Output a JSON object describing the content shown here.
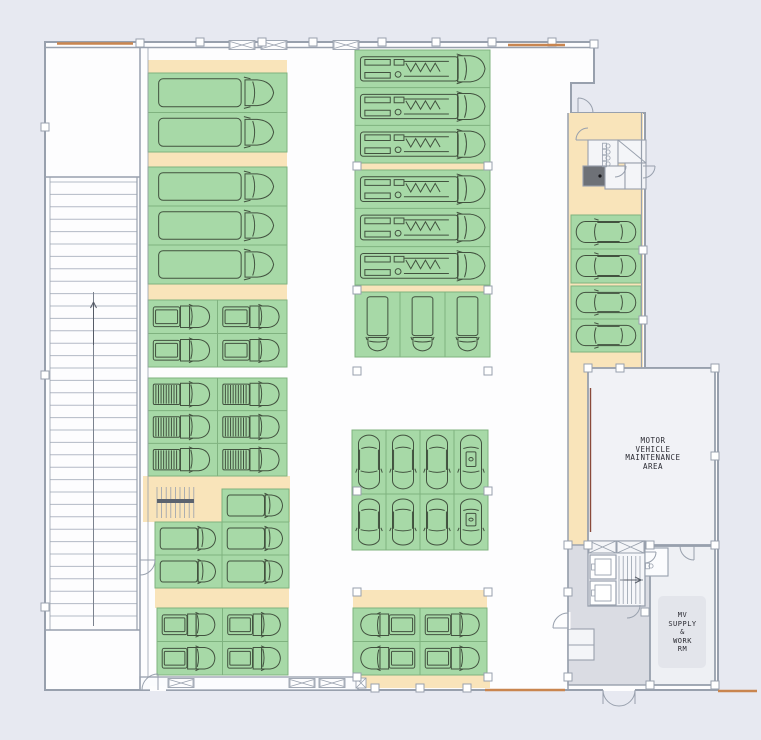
{
  "labels": {
    "maintenance": "MOTOR\nVEHICLE\nMAINTENANCE\nAREA",
    "supply": "MV\nSUPPLY\n&\nWORK\nRM"
  },
  "colors": {
    "page_bg": "#e7e9f1",
    "floor": "#fdfdfe",
    "wall": "#98a0ad",
    "wall_light": "#b3bac5",
    "tan": "#f9e4ba",
    "stall_green": "#a7d9a7",
    "stall_border": "#7fb27f",
    "vehicle": "#42523f",
    "lobby_gray": "#dadce3",
    "room_light": "#f2f3f7",
    "dark_unit": "#6e7177",
    "accent_orange": "#c9854f",
    "accent_brown": "#8a4a3a",
    "label_text": "#2b2b33"
  },
  "plan": {
    "w": 761,
    "h": 740,
    "outline": "M45,42 H594 V83 H571 V113 H645 V368 H718 V690 H45 Z",
    "tan": [
      [
        148,
        60,
        139,
        13
      ],
      [
        148,
        152,
        139,
        15
      ],
      [
        148,
        284,
        139,
        16
      ],
      [
        143,
        476,
        147,
        46
      ],
      [
        155,
        588,
        134,
        20
      ],
      [
        355,
        163,
        135,
        7
      ],
      [
        355,
        285,
        135,
        7
      ],
      [
        353,
        590,
        134,
        18
      ],
      [
        353,
        675,
        137,
        13
      ],
      [
        568,
        113,
        75,
        262
      ],
      [
        568,
        375,
        20,
        170
      ]
    ],
    "rooms": [
      {
        "x": 588,
        "y": 368,
        "w": 127,
        "h": 177,
        "fill": "#f1f2f6",
        "sw": 1.8,
        "name": "room-maintenance-area"
      },
      {
        "x": 568,
        "y": 545,
        "w": 84,
        "h": 140,
        "fill": "#dadce3",
        "sw": 1.4,
        "name": "lobby"
      },
      {
        "x": 650,
        "y": 546,
        "w": 65,
        "h": 139,
        "fill": "#eef0f4",
        "sw": 1.8,
        "name": "room-supply"
      },
      {
        "x": 588,
        "y": 541,
        "w": 57,
        "h": 65,
        "fill": "#f6f7fa",
        "sw": 1.3,
        "name": "elevator-stair-block"
      },
      {
        "x": 645,
        "y": 548,
        "w": 23,
        "h": 28,
        "fill": "#fbfcfe",
        "sw": 1.1,
        "name": "restroom"
      },
      {
        "x": 588,
        "y": 140,
        "w": 30,
        "h": 26,
        "fill": "#f4f5f8",
        "sw": 1.1,
        "name": "restroom-stalls-room"
      },
      {
        "x": 618,
        "y": 140,
        "w": 28,
        "h": 23,
        "fill": "#f4f5f8",
        "sw": 1.1,
        "name": "stair-room"
      },
      {
        "x": 583,
        "y": 166,
        "w": 23,
        "h": 20,
        "fill": "#6e7177",
        "sw": 1.1,
        "name": "utility-unit"
      },
      {
        "x": 605,
        "y": 166,
        "w": 20,
        "h": 23,
        "fill": "#f4f5f8",
        "sw": 1.1,
        "name": "small-room"
      },
      {
        "x": 625,
        "y": 163,
        "w": 21,
        "h": 26,
        "fill": "#f4f5f8",
        "sw": 1.1,
        "name": "small-room"
      },
      {
        "x": 140,
        "y": 677,
        "w": 218,
        "h": 13,
        "fill": "#fbfcfe",
        "sw": 1.3,
        "name": "service-corridor"
      },
      {
        "x": 568,
        "y": 629,
        "w": 26,
        "h": 31,
        "fill": "#f4f5f8",
        "sw": 1.1,
        "name": "closets"
      },
      {
        "x": 658,
        "y": 596,
        "w": 48,
        "h": 72,
        "fill": "#e3e5eb",
        "sw": 0,
        "rx": 5,
        "name": "label-plate"
      },
      {
        "x": 566,
        "y": 612,
        "w": 4.5,
        "h": 17,
        "fill": "#fdfdfe",
        "sw": 0,
        "name": "door-gap"
      },
      {
        "x": 603,
        "y": 686,
        "w": 32,
        "h": 5,
        "fill": "#fdfdfe",
        "sw": 0,
        "name": "door-gap"
      },
      {
        "x": 138,
        "y": 560,
        "w": 4.5,
        "h": 16,
        "fill": "#fdfdfe",
        "sw": 0,
        "name": "door-gap"
      },
      {
        "x": 150,
        "y": 686,
        "w": 16,
        "h": 5,
        "fill": "#fdfdfe",
        "sw": 0,
        "name": "door-gap"
      }
    ],
    "blocks": [
      {
        "x": 148,
        "y": 73,
        "w": 139,
        "h": 79,
        "r": 2,
        "c": 1,
        "v": "boxtruck",
        "dir": 0
      },
      {
        "x": 148,
        "y": 167,
        "w": 139,
        "h": 117,
        "r": 3,
        "c": 1,
        "v": "boxtruck",
        "dir": 0
      },
      {
        "x": 148,
        "y": 300,
        "w": 139,
        "h": 67,
        "r": 2,
        "c": 2,
        "v": "pickup",
        "dir": 0
      },
      {
        "x": 148,
        "y": 378,
        "w": 139,
        "h": 98,
        "r": 3,
        "c": 2,
        "v": "staketruck",
        "dir": 0
      },
      {
        "x": 222,
        "y": 489,
        "w": 67,
        "h": 33,
        "r": 1,
        "c": 1,
        "v": "van",
        "dir": 0
      },
      {
        "x": 155,
        "y": 522,
        "w": 134,
        "h": 66,
        "r": 2,
        "c": 2,
        "v": "van",
        "dir": 0
      },
      {
        "x": 157,
        "y": 608,
        "w": 131,
        "h": 67,
        "r": 2,
        "c": 2,
        "v": "pickup",
        "dir": 0
      },
      {
        "x": 355,
        "y": 50,
        "w": 135,
        "h": 113,
        "r": 3,
        "c": 1,
        "v": "firetruck",
        "dir": 0
      },
      {
        "x": 355,
        "y": 170,
        "w": 135,
        "h": 115,
        "r": 3,
        "c": 1,
        "v": "firetruck",
        "dir": 0
      },
      {
        "x": 355,
        "y": 292,
        "w": 135,
        "h": 65,
        "r": 1,
        "c": 3,
        "v": "boxtruck",
        "dir": 90
      },
      {
        "x": 352,
        "y": 430,
        "w": 136,
        "h": 64,
        "r": 1,
        "c": 4,
        "v": "car",
        "dir": 90,
        "special": [
          3
        ]
      },
      {
        "x": 352,
        "y": 494,
        "w": 136,
        "h": 56,
        "r": 1,
        "c": 4,
        "v": "car",
        "dir": 90,
        "special": [
          3
        ]
      },
      {
        "x": 353,
        "y": 608,
        "w": 134,
        "h": 67,
        "r": 2,
        "c": 2,
        "v": "pickup",
        "coldirs": [
          180,
          0
        ]
      },
      {
        "x": 571,
        "y": 215,
        "w": 70,
        "h": 68,
        "r": 2,
        "c": 1,
        "v": "car",
        "dir": 180
      },
      {
        "x": 571,
        "y": 286,
        "w": 70,
        "h": 66,
        "r": 2,
        "c": 1,
        "v": "car",
        "dir": 180
      }
    ],
    "lines": [
      [
        140,
        42,
        140,
        690
      ],
      [
        148,
        48,
        148,
        677,
        0.8
      ],
      [
        45,
        177,
        140,
        177
      ],
      [
        45,
        630,
        140,
        630
      ],
      [
        45,
        47.5,
        594,
        47.5
      ],
      [
        50,
        177,
        50,
        630,
        0.8
      ],
      [
        137,
        177,
        137,
        630,
        1.2
      ],
      [
        568,
        113,
        568,
        690
      ],
      [
        641.5,
        113,
        641.5,
        368,
        1.2
      ],
      [
        358,
        677,
        358,
        690,
        1.2
      ],
      [
        568,
        645,
        594,
        645,
        1
      ]
    ],
    "stairs": [
      {
        "dir": "h",
        "x": 50,
        "y": 182,
        "w": 87,
        "h": 446,
        "step": 12.4,
        "center": [
          93.5,
          292,
          93.5,
          626
        ]
      },
      {
        "dir": "v",
        "x": 157,
        "y": 487,
        "w": 37,
        "h": 31,
        "step": 4.6,
        "band": [
          157,
          501,
          194,
          501
        ]
      },
      {
        "dir": "v",
        "x": 619,
        "y": 556,
        "w": 25,
        "h": 48,
        "step": 4.2,
        "center": [
          620,
          580,
          643,
          580
        ]
      }
    ],
    "arrows": [
      {
        "x1": 93.5,
        "y1": 345,
        "x2": 93.5,
        "y2": 302
      },
      {
        "x1": 624,
        "y1": 580,
        "x2": 641,
        "y2": 580
      }
    ],
    "arcs": [
      "M578,98 L578,113 M578,98 A15,15 0 0 1 593,113",
      "M588,140 L576,140 M576,140 A12,12 0 0 1 588,128",
      "M615,166 L626,166 M626,166 A11,11 0 0 1 615,177",
      "M643,166 L655,166 M655,166 A12,12 0 0 1 643,178",
      "M568,628 L553,628 M553,628 A15,15 0 0 1 568,613",
      "M694,546 L694,560 M694,560 A14,14 0 0 1 680,546",
      "M603,690 L603,704 M603,690 A16,16 0 0 0 619,706",
      "M635,690 L635,704 M635,690 A16,16 0 0 1 619,706",
      "M140,560 L155,560 M155,560 A15,15 0 0 1 140,575",
      "M158,690 L158,674 M158,674 A16,16 0 0 0 142,690",
      "M640,605 A13,13 0 0 1 627,618",
      "M645,552 L656,552 M656,552 A11,11 0 0 1 645,563"
    ],
    "bowties": [
      [
        242,
        45
      ],
      [
        274,
        45
      ],
      [
        346,
        45
      ],
      [
        181,
        683
      ],
      [
        302,
        683
      ],
      [
        332,
        683
      ]
    ],
    "xsquares": [
      [
        361,
        683
      ]
    ],
    "vents": [
      [
        589,
        541,
        27,
        12
      ],
      [
        617,
        541,
        27,
        12
      ]
    ],
    "elevators": [
      [
        590,
        555,
        26,
        24
      ],
      [
        590,
        581,
        26,
        24
      ]
    ],
    "markers": [
      [
        200,
        42
      ],
      [
        262,
        42
      ],
      [
        313,
        42
      ],
      [
        382,
        42
      ],
      [
        436,
        42
      ],
      [
        492,
        42
      ],
      [
        552,
        42
      ],
      [
        140,
        43
      ],
      [
        594,
        44
      ],
      [
        357,
        166
      ],
      [
        488,
        166
      ],
      [
        357,
        290
      ],
      [
        488,
        290
      ],
      [
        357,
        371
      ],
      [
        488,
        371
      ],
      [
        357,
        491
      ],
      [
        488,
        491
      ],
      [
        357,
        592
      ],
      [
        488,
        592
      ],
      [
        357,
        677
      ],
      [
        488,
        677
      ],
      [
        643,
        250
      ],
      [
        643,
        320
      ],
      [
        620,
        368
      ],
      [
        588,
        368
      ],
      [
        715,
        368
      ],
      [
        715,
        456
      ],
      [
        588,
        545
      ],
      [
        650,
        545
      ],
      [
        715,
        545
      ],
      [
        568,
        545
      ],
      [
        568,
        592
      ],
      [
        568,
        677
      ],
      [
        650,
        685
      ],
      [
        715,
        685
      ],
      [
        645,
        612
      ],
      [
        45,
        127
      ],
      [
        45,
        375
      ],
      [
        45,
        607
      ],
      [
        375,
        688
      ],
      [
        420,
        688
      ],
      [
        467,
        688
      ]
    ],
    "fixtures": [
      [
        608,
        146
      ],
      [
        608,
        152
      ],
      [
        608,
        158
      ],
      [
        608,
        164
      ],
      [
        651,
        566
      ]
    ],
    "darkdots": [
      [
        600,
        176
      ]
    ],
    "diag": [
      [
        618,
        140,
        646,
        163
      ]
    ],
    "brown": [
      [
        590.5,
        388,
        590.5,
        532
      ]
    ],
    "orange": [
      [
        57,
        43.5,
        133,
        43.5
      ],
      [
        508,
        45,
        565,
        45
      ],
      [
        485,
        690,
        565,
        690
      ],
      [
        718,
        691,
        757,
        691
      ]
    ]
  }
}
